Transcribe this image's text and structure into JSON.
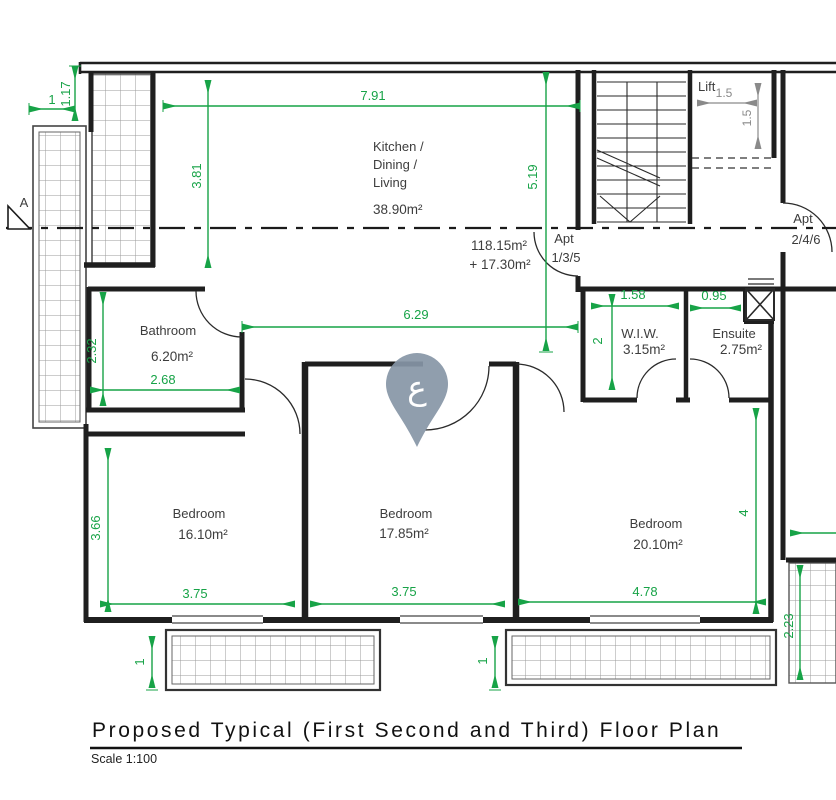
{
  "title": {
    "main": "Proposed Typical (First Second and Third) Floor Plan",
    "scale": "Scale 1:100"
  },
  "rooms": {
    "kitchen": {
      "line1": "Kitchen /",
      "line2": "Dining /",
      "line3": "Living",
      "area": "38.90m²"
    },
    "bathroom": {
      "name": "Bathroom",
      "area": "6.20m²"
    },
    "wiw": {
      "name": "W.I.W.",
      "area": "3.15m²"
    },
    "ensuite": {
      "name": "Ensuite",
      "area": "2.75m²"
    },
    "bedroom1": {
      "name": "Bedroom",
      "area": "16.10m²"
    },
    "bedroom2": {
      "name": "Bedroom",
      "area": "17.85m²"
    },
    "bedroom3": {
      "name": "Bedroom",
      "area": "20.10m²"
    },
    "lift": {
      "name": "Lift"
    }
  },
  "apartment": {
    "area_total": "118.15m²",
    "area_extra": "+ 17.30m²",
    "apt135_line1": "Apt",
    "apt135_line2": "1/3/5",
    "apt246_line1": "Apt",
    "apt246_line2": "2/4/6"
  },
  "dimensions": {
    "top_offset_v": "1.17",
    "top_offset_h": "1",
    "kitchen_width": "7.91",
    "kitchen_height_left": "3.81",
    "kitchen_height_right": "5.19",
    "hallway_width": "6.29",
    "bathroom_height": "2.32",
    "bathroom_width": "2.68",
    "wiw_width": "1.58",
    "wiw_height": "2",
    "ensuite_width": "0.95",
    "bedroom1_height": "3.66",
    "bedroom1_width": "3.75",
    "bedroom2_width": "3.75",
    "bedroom3_width": "4.78",
    "bedroom3_height": "4",
    "balcony_left_depth": "1",
    "balcony_right_depth": "1",
    "balcony_side_height": "2.23"
  },
  "lift_dims": {
    "width": "1.5",
    "height": "1.5"
  },
  "section_marker": {
    "label": "A"
  },
  "watermark": {
    "letter": "ع"
  },
  "colors": {
    "dimension_green": "#17a347",
    "wall_black": "#1f1f1f",
    "tile_gray": "#9b9b9b",
    "lift_dim_gray": "#8a8a8a",
    "watermark_blue": "#8796a7"
  }
}
